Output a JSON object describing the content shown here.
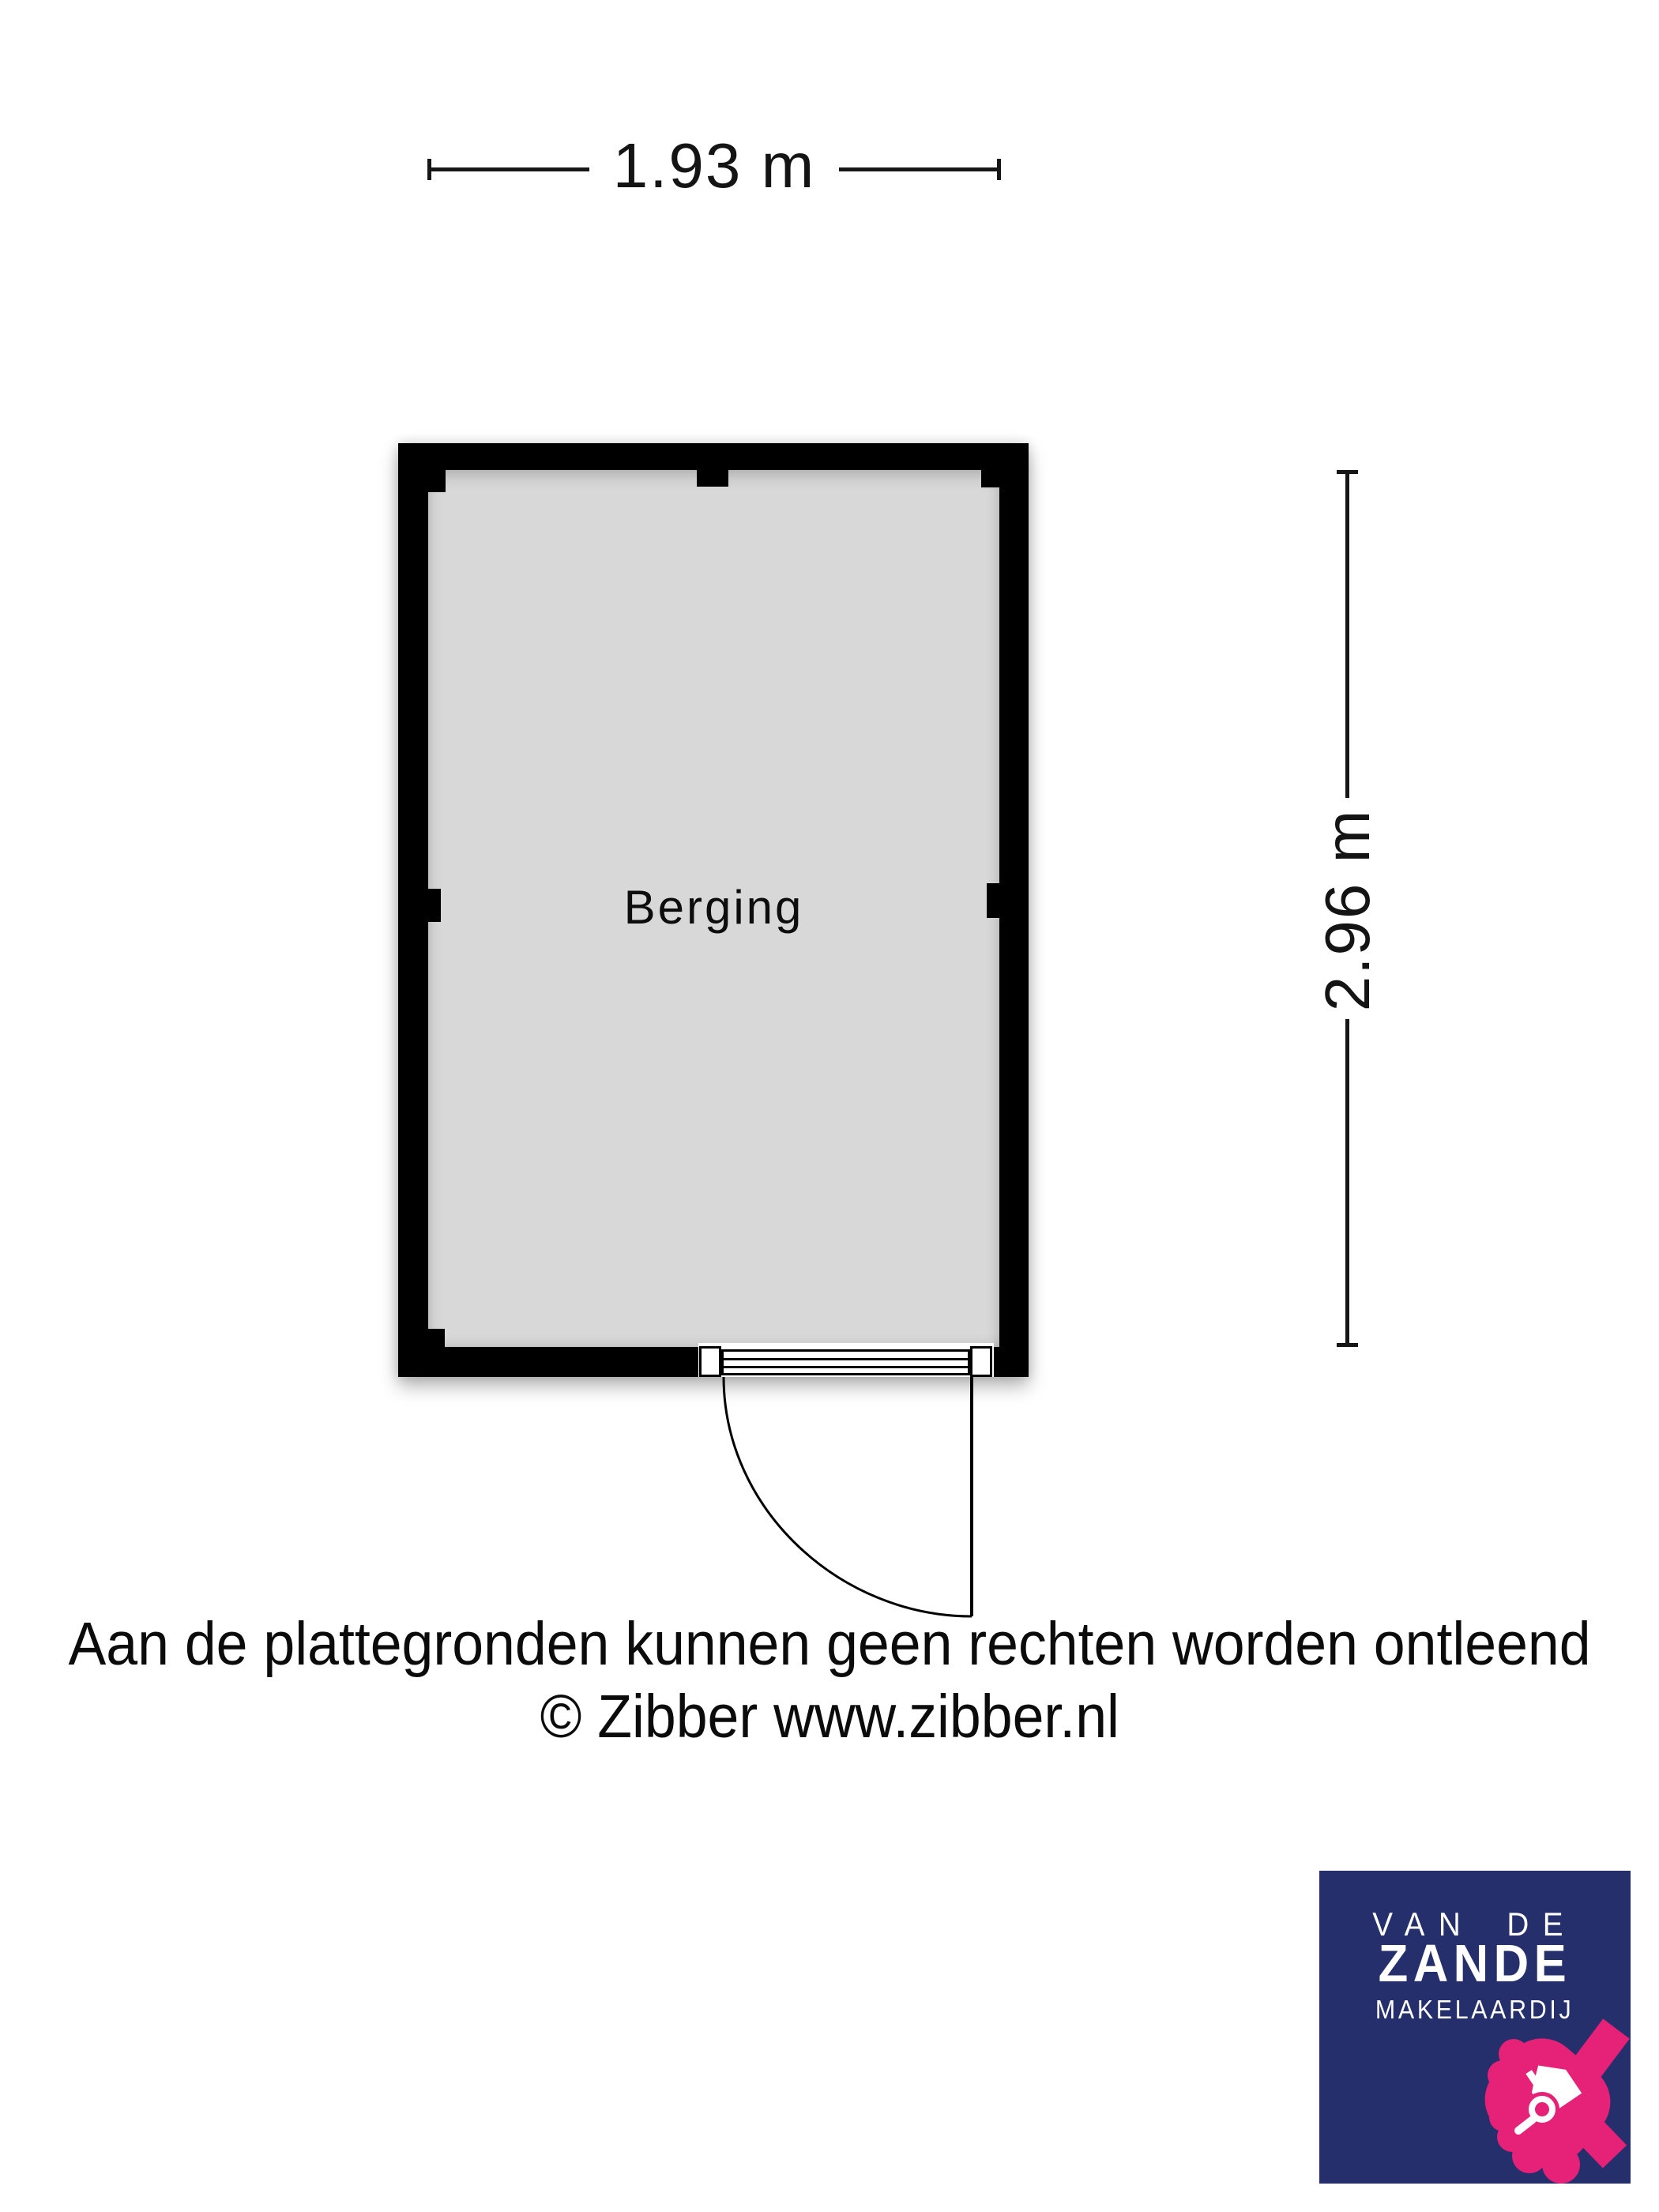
{
  "floor_plan": {
    "room_label": "Berging",
    "width_dimension": "1.93 m",
    "height_dimension": "2.96 m",
    "wall_color": "#000000",
    "floor_color": "#d8d8d8"
  },
  "disclaimer": {
    "line1": "Aan de plattegronden kunnen geen rechten worden ontleend",
    "line2": "© Zibber www.zibber.nl"
  },
  "logo": {
    "top": "VAN DE",
    "name": "ZANDE",
    "subtitle": "MAKELAARDIJ",
    "background_color": "#252f6b",
    "accent_color": "#e52178",
    "text_color": "#ffffff",
    "icon": "hand-holding-house-with-magnifier"
  }
}
